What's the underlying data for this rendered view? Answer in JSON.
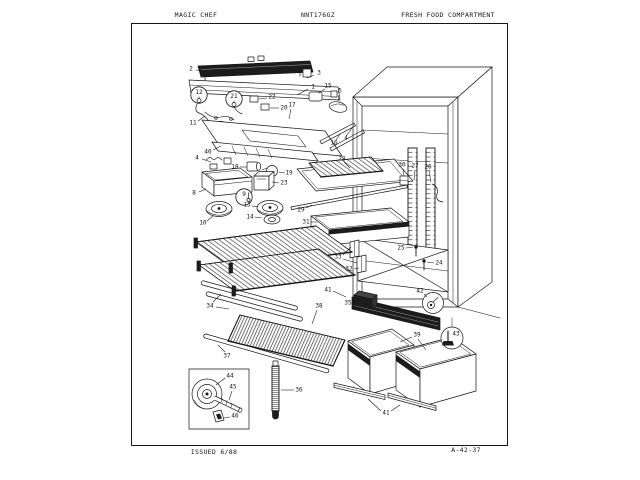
{
  "page": {
    "paper": "#ffffff",
    "ink": "#161616"
  },
  "header": {
    "brand": "MAGIC CHEF",
    "model": "NNT176GZ",
    "section": "FRESH FOOD COMPARTMENT"
  },
  "footer": {
    "issued": "ISSUED 6/88",
    "code": "A-42-37"
  },
  "diagram": {
    "callouts": [
      {
        "n": "2",
        "x": 191,
        "y": 69,
        "leads": [
          [
            196,
            70,
            207,
            71
          ]
        ]
      },
      {
        "n": "3",
        "x": 319,
        "y": 73,
        "leads": [
          [
            314,
            75,
            307,
            78
          ]
        ]
      },
      {
        "n": "1",
        "x": 313,
        "y": 87,
        "leads": [
          [
            308,
            89,
            297,
            95
          ]
        ]
      },
      {
        "n": "15",
        "x": 328,
        "y": 86,
        "leads": [
          [
            325,
            89,
            319,
            93
          ]
        ]
      },
      {
        "n": "5",
        "x": 340,
        "y": 91,
        "leads": [
          [
            339,
            95,
            338,
            101
          ]
        ]
      },
      {
        "n": "12",
        "x": 199,
        "y": 95,
        "circled": true
      },
      {
        "n": "21",
        "x": 234,
        "y": 99,
        "circled": true
      },
      {
        "n": "22",
        "x": 272,
        "y": 97,
        "leads": [
          [
            267,
            98,
            259,
            99
          ]
        ]
      },
      {
        "n": "20",
        "x": 284,
        "y": 108,
        "leads": [
          [
            279,
            108,
            270,
            108
          ]
        ]
      },
      {
        "n": "17",
        "x": 292,
        "y": 105,
        "leads": [
          [
            291,
            109,
            289,
            119
          ]
        ]
      },
      {
        "n": "11",
        "x": 193,
        "y": 123,
        "leads": [
          [
            198,
            121,
            205,
            116
          ]
        ]
      },
      {
        "n": "40",
        "x": 208,
        "y": 152,
        "leads": [
          [
            213,
            150,
            221,
            146
          ]
        ]
      },
      {
        "n": "4",
        "x": 197,
        "y": 158,
        "leads": [
          [
            202,
            159,
            211,
            162
          ]
        ]
      },
      {
        "id": "4b",
        "n": "4",
        "x": 346,
        "y": 138,
        "leads": [
          [
            347,
            135,
            352,
            128
          ]
        ]
      },
      {
        "n": "16",
        "x": 334,
        "y": 143,
        "leads": [
          [
            336,
            140,
            340,
            134
          ]
        ]
      },
      {
        "n": "18",
        "x": 235,
        "y": 167,
        "leads": [
          [
            240,
            167,
            247,
            167
          ]
        ]
      },
      {
        "n": "19",
        "x": 289,
        "y": 173,
        "leads": [
          [
            285,
            173,
            279,
            172
          ]
        ]
      },
      {
        "n": "23",
        "x": 284,
        "y": 183,
        "leads": [
          [
            279,
            183,
            272,
            182
          ]
        ]
      },
      {
        "n": "8",
        "x": 194,
        "y": 193,
        "leads": [
          [
            199,
            192,
            206,
            189
          ]
        ]
      },
      {
        "n": "9",
        "x": 244,
        "y": 197,
        "circled": true
      },
      {
        "n": "13",
        "x": 247,
        "y": 205,
        "leads": [
          [
            252,
            206,
            258,
            207
          ]
        ]
      },
      {
        "n": "10",
        "x": 203,
        "y": 223,
        "leads": [
          [
            207,
            221,
            213,
            216
          ]
        ]
      },
      {
        "n": "14",
        "x": 250,
        "y": 217,
        "leads": [
          [
            255,
            217,
            262,
            218
          ]
        ]
      },
      {
        "n": "28",
        "x": 342,
        "y": 159,
        "leads": [
          [
            344,
            162,
            350,
            168
          ]
        ]
      },
      {
        "n": "30",
        "x": 402,
        "y": 165,
        "leads": [
          [
            403,
            169,
            404,
            176
          ]
        ]
      },
      {
        "n": "27",
        "x": 415,
        "y": 166,
        "leads": [
          [
            415,
            170,
            414,
            180
          ]
        ]
      },
      {
        "n": "26",
        "x": 428,
        "y": 167,
        "leads": [
          [
            429,
            171,
            431,
            182
          ]
        ]
      },
      {
        "n": "29",
        "x": 301,
        "y": 210,
        "leads": [
          [
            306,
            208,
            312,
            205
          ]
        ]
      },
      {
        "n": "31",
        "x": 306,
        "y": 222,
        "leads": [
          [
            311,
            222,
            317,
            222
          ]
        ]
      },
      {
        "n": "33",
        "x": 338,
        "y": 257,
        "leads": [
          [
            343,
            255,
            351,
            247
          ],
          [
            343,
            259,
            357,
            263
          ]
        ]
      },
      {
        "n": "32",
        "x": 349,
        "y": 269,
        "leads": [
          [
            354,
            269,
            359,
            268
          ]
        ]
      },
      {
        "n": "25",
        "x": 401,
        "y": 248,
        "leads": [
          [
            406,
            248,
            413,
            247
          ]
        ]
      },
      {
        "n": "24",
        "x": 439,
        "y": 263,
        "leads": [
          [
            434,
            263,
            427,
            262
          ]
        ]
      },
      {
        "n": "34",
        "x": 210,
        "y": 306,
        "leads": [
          [
            213,
            302,
            221,
            294
          ],
          [
            216,
            307,
            229,
            309
          ]
        ]
      },
      {
        "n": "35",
        "x": 348,
        "y": 303,
        "leads": [
          [
            352,
            302,
            356,
            300
          ]
        ]
      },
      {
        "n": "38",
        "x": 319,
        "y": 306,
        "leads": [
          [
            317,
            310,
            312,
            324
          ]
        ]
      },
      {
        "n": "37",
        "x": 227,
        "y": 356,
        "leads": [
          [
            225,
            352,
            218,
            345
          ]
        ]
      },
      {
        "n": "36",
        "x": 299,
        "y": 390,
        "leads": [
          [
            294,
            390,
            281,
            390
          ]
        ]
      },
      {
        "n": "41",
        "x": 328,
        "y": 290,
        "leads": [
          [
            333,
            291,
            346,
            297
          ]
        ]
      },
      {
        "id": "41b",
        "n": "41",
        "x": 386,
        "y": 413,
        "leads": [
          [
            381,
            411,
            368,
            399
          ],
          [
            391,
            411,
            400,
            405
          ]
        ]
      },
      {
        "n": "39",
        "x": 417,
        "y": 335,
        "leads": [
          [
            412,
            337,
            400,
            342
          ],
          [
            418,
            339,
            426,
            350
          ]
        ]
      },
      {
        "n": "42",
        "x": 420,
        "y": 291,
        "leads": [
          [
            424,
            294,
            427,
            297
          ]
        ]
      },
      {
        "n": "43",
        "x": 456,
        "y": 334
      },
      {
        "n": "44",
        "x": 230,
        "y": 376,
        "leads": [
          [
            225,
            378,
            216,
            385
          ]
        ]
      },
      {
        "n": "45",
        "x": 233,
        "y": 387,
        "leads": [
          [
            232,
            391,
            229,
            400
          ]
        ]
      },
      {
        "n": "46",
        "x": 235,
        "y": 416,
        "leads": [
          [
            230,
            417,
            224,
            418
          ]
        ]
      }
    ]
  }
}
